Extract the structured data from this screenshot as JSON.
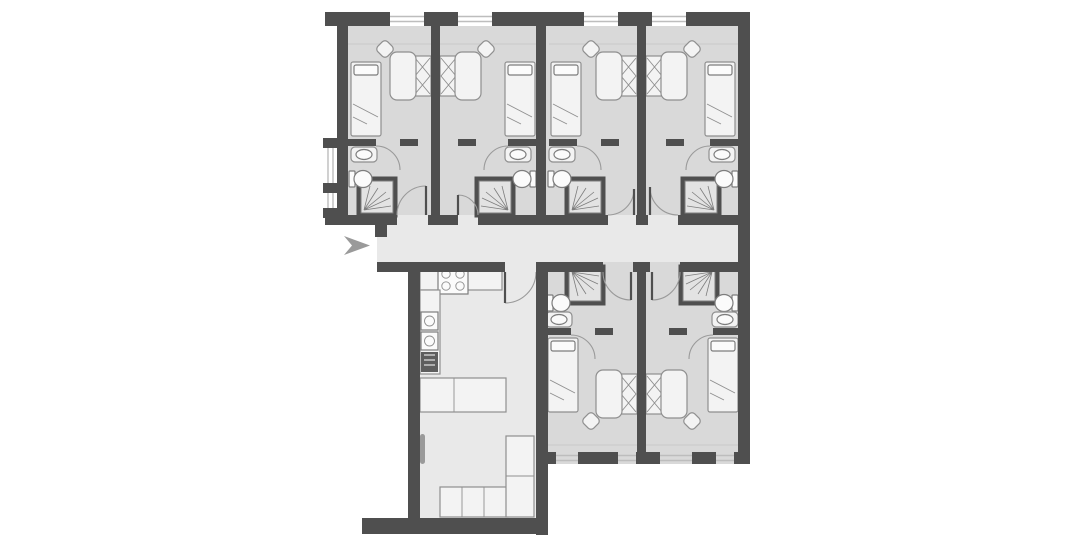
{
  "document": {
    "type": "floor-plan",
    "title": "Shared apartment floor plan"
  },
  "palette": {
    "wall": "#4f4f4f",
    "room": "#d9d9d9",
    "hall": "#e9e9e9",
    "furnFill": "#f3f3f3",
    "furnStroke": "#8f8f8f",
    "fixStroke": "#7d7d7d",
    "winLine": "#bdbdbd",
    "shower": "#e3e3e3",
    "appliance": "#5e5e5e",
    "marker": "#9a9a9a"
  },
  "entrance": {
    "marker": "right-chevron-arrow",
    "location": "west-end-of-corridor"
  },
  "rooms": [
    {
      "name": "bedroom-1",
      "position": "top-row-far-left",
      "fixtures": [
        "single-bed",
        "desk",
        "chair",
        "wardrobe",
        "shower",
        "toilet",
        "sink",
        "en-suite-door",
        "entry-door"
      ]
    },
    {
      "name": "bedroom-2",
      "position": "top-row-center-left",
      "fixtures": [
        "single-bed",
        "desk",
        "chair",
        "wardrobe",
        "shower",
        "toilet",
        "sink",
        "en-suite-door",
        "entry-door"
      ]
    },
    {
      "name": "bedroom-3",
      "position": "top-row-center-right",
      "fixtures": [
        "single-bed",
        "desk",
        "chair",
        "wardrobe",
        "shower",
        "toilet",
        "sink",
        "en-suite-door",
        "entry-door"
      ]
    },
    {
      "name": "bedroom-4",
      "position": "top-row-far-right",
      "fixtures": [
        "single-bed",
        "desk",
        "chair",
        "wardrobe",
        "shower",
        "toilet",
        "sink",
        "en-suite-door",
        "entry-door"
      ]
    },
    {
      "name": "bedroom-5",
      "position": "bottom-row-left",
      "fixtures": [
        "single-bed",
        "desk",
        "chair",
        "wardrobe",
        "shower",
        "toilet",
        "sink",
        "en-suite-door",
        "entry-door"
      ]
    },
    {
      "name": "bedroom-6",
      "position": "bottom-row-right",
      "fixtures": [
        "single-bed",
        "desk",
        "chair",
        "wardrobe",
        "shower",
        "toilet",
        "sink",
        "en-suite-door",
        "entry-door"
      ]
    },
    {
      "name": "corridor",
      "position": "central-horizontal-hall",
      "fixtures": [
        "entrance-arrow"
      ]
    },
    {
      "name": "kitchen-living-room",
      "position": "bottom-left",
      "fixtures": [
        "stove",
        "counter",
        "kitchen-sink",
        "appliance",
        "bar-counter",
        "corner-sofa",
        "side-door"
      ]
    }
  ],
  "windows": {
    "top_wall": 4,
    "bottom_wall": 4,
    "left_wall_recesses": 2
  }
}
